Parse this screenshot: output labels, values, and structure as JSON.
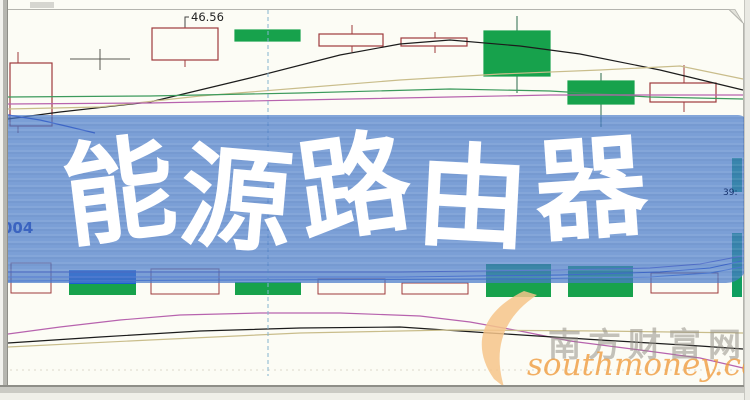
{
  "banner": {
    "title": "能源路由器",
    "chars": [
      {
        "ch": "能",
        "rot": -7,
        "dy": 2
      },
      {
        "ch": "源",
        "rot": 5,
        "dy": 10
      },
      {
        "ch": "路",
        "rot": -8,
        "dy": -3
      },
      {
        "ch": "由",
        "rot": 3,
        "dy": 8
      },
      {
        "ch": "器",
        "rot": -4,
        "dy": -1
      }
    ],
    "bg_rgba": "rgba(74,124,203,0.72)",
    "text_color": "#ffffff",
    "stock_code_fragment": "004",
    "small_price_label": "39:"
  },
  "price_label": {
    "value": "46.56"
  },
  "watermark": {
    "site_name": "南方财富网",
    "site_url": "southmoney.com",
    "name_color": "rgba(148,144,134,0.55)",
    "url_color": "rgba(238,152,58,0.78)",
    "swoosh_color": "rgba(246,196,138,0.85)"
  },
  "colors": {
    "chart_bg": "#fcfcf5",
    "frame": "#b4b4ae",
    "candle_up_outline": "#9e3a3c",
    "candle_down_fill": "#17a24c",
    "crosshair": "#85b4cf",
    "banner_blue": "#7b9dd9",
    "teal_under_banner": "#0f9f60"
  },
  "chart_data": {
    "type": "candlestick",
    "units": "pixels",
    "price_annotation": {
      "text": "46.56",
      "text_x": 191,
      "text_y": 21,
      "connector": [
        [
          185,
          27
        ],
        [
          185,
          17
        ],
        [
          189,
          17
        ]
      ]
    },
    "crosshair_x": 268,
    "candles": [
      {
        "x": 10,
        "w": 42,
        "top": 63,
        "bottom": 126,
        "wick_x": 18,
        "wick_top": 52,
        "wick_bottom": 133,
        "kind": "hollow"
      },
      {
        "x": 152,
        "w": 66,
        "top": 28,
        "bottom": 60,
        "wick_x": 185,
        "wick_top": 17,
        "wick_bottom": 67,
        "kind": "hollow"
      },
      {
        "x": 235,
        "w": 65,
        "top": 30,
        "bottom": 41,
        "wick_x": 268,
        "wick_top": 30,
        "wick_bottom": 41,
        "kind": "filled"
      },
      {
        "x": 319,
        "w": 64,
        "top": 34,
        "bottom": 46,
        "wick_x": 352,
        "wick_top": 25,
        "wick_bottom": 52,
        "kind": "hollow"
      },
      {
        "x": 401,
        "w": 66,
        "top": 38,
        "bottom": 46,
        "wick_x": 435,
        "wick_top": 32,
        "wick_bottom": 53,
        "kind": "hollow"
      },
      {
        "x": 484,
        "w": 66,
        "top": 31,
        "bottom": 76,
        "wick_x": 517,
        "wick_top": 16,
        "wick_bottom": 93,
        "kind": "filled"
      },
      {
        "x": 568,
        "w": 66,
        "top": 81,
        "bottom": 104,
        "wick_x": 601,
        "wick_top": 73,
        "wick_bottom": 127,
        "kind": "filled"
      },
      {
        "x": 650,
        "w": 66,
        "top": 83,
        "bottom": 102,
        "wick_x": 684,
        "wick_top": 65,
        "wick_bottom": 112,
        "kind": "hollow"
      }
    ],
    "doji": {
      "color": "#5a5a52",
      "cx": 100,
      "line_y": 59,
      "x1": 70,
      "x2": 130,
      "wick_top": 49,
      "wick_bottom": 70
    },
    "ma_lines": [
      {
        "name": "ma-black",
        "color": "#1c1c1c",
        "points": [
          [
            8,
            119
          ],
          [
            60,
            112
          ],
          [
            150,
            102
          ],
          [
            250,
            78
          ],
          [
            340,
            55
          ],
          [
            400,
            44
          ],
          [
            450,
            40
          ],
          [
            520,
            46
          ],
          [
            580,
            54
          ],
          [
            660,
            70
          ],
          [
            743,
            90
          ]
        ]
      },
      {
        "name": "ma-khaki",
        "color": "#c9bd8b",
        "points": [
          [
            8,
            109
          ],
          [
            100,
            107
          ],
          [
            200,
            96
          ],
          [
            300,
            88
          ],
          [
            400,
            80
          ],
          [
            500,
            74
          ],
          [
            600,
            70
          ],
          [
            680,
            66
          ],
          [
            743,
            79
          ]
        ]
      },
      {
        "name": "ma-green",
        "color": "#3c9a5c",
        "points": [
          [
            8,
            97
          ],
          [
            150,
            96
          ],
          [
            300,
            93
          ],
          [
            450,
            89
          ],
          [
            550,
            91
          ],
          [
            650,
            97
          ],
          [
            743,
            99
          ]
        ]
      },
      {
        "name": "ma-magenta",
        "color": "#b763ae",
        "points": [
          [
            8,
            104
          ],
          [
            150,
            103
          ],
          [
            300,
            100
          ],
          [
            450,
            97
          ],
          [
            550,
            95
          ],
          [
            650,
            95
          ],
          [
            743,
            95
          ]
        ]
      },
      {
        "name": "ma-blue",
        "color": "#2336c6",
        "points": [
          [
            8,
            115
          ],
          [
            40,
            120
          ],
          [
            70,
            127
          ],
          [
            95,
            133
          ]
        ]
      }
    ],
    "volume_bars": [
      {
        "x": 11,
        "w": 40,
        "segments": [
          {
            "y1": 263,
            "y2": 293,
            "fill": "none",
            "stroke": "#9e3a3c"
          }
        ]
      },
      {
        "x": 69,
        "w": 67,
        "segments": [
          {
            "y1": 270,
            "y2": 284,
            "fill": "#1a5fd0"
          },
          {
            "y1": 284,
            "y2": 295,
            "fill": "#17a24c"
          }
        ]
      },
      {
        "x": 151,
        "w": 68,
        "segments": [
          {
            "y1": 269,
            "y2": 294,
            "fill": "none",
            "stroke": "#9e3a3c"
          }
        ]
      },
      {
        "x": 235,
        "w": 66,
        "segments": [
          {
            "y1": 282,
            "y2": 295,
            "fill": "#17a24c"
          }
        ]
      },
      {
        "x": 318,
        "w": 67,
        "segments": [
          {
            "y1": 279,
            "y2": 294,
            "fill": "none",
            "stroke": "#9e3a3c"
          }
        ]
      },
      {
        "x": 402,
        "w": 66,
        "segments": [
          {
            "y1": 283,
            "y2": 294,
            "fill": "none",
            "stroke": "#9e3a3c"
          }
        ]
      },
      {
        "x": 486,
        "w": 65,
        "segments": [
          {
            "y1": 264,
            "y2": 297,
            "fill": "#17a24c"
          }
        ]
      },
      {
        "x": 568,
        "w": 65,
        "segments": [
          {
            "y1": 266,
            "y2": 297,
            "fill": "#17a24c"
          }
        ]
      },
      {
        "x": 651,
        "w": 67,
        "segments": [
          {
            "y1": 273,
            "y2": 293,
            "fill": "none",
            "stroke": "#9e3a3c"
          }
        ]
      },
      {
        "x": 732,
        "w": 10,
        "segments": [
          {
            "y1": 158,
            "y2": 192,
            "fill": "#0f9f60"
          },
          {
            "y1": 233,
            "y2": 297,
            "fill": "#0f9f60"
          }
        ]
      }
    ],
    "volume_lines": [
      {
        "color": "#6a55c8",
        "points": [
          [
            8,
            272
          ],
          [
            200,
            272
          ],
          [
            400,
            272
          ],
          [
            560,
            270
          ],
          [
            650,
            268
          ],
          [
            700,
            264
          ],
          [
            742,
            256
          ]
        ]
      },
      {
        "color": "#2a3ec8",
        "points": [
          [
            8,
            277
          ],
          [
            200,
            277
          ],
          [
            400,
            277
          ],
          [
            560,
            275
          ],
          [
            660,
            272
          ],
          [
            710,
            268
          ],
          [
            742,
            261
          ]
        ]
      },
      {
        "color": "#4a6ad8",
        "points": [
          [
            8,
            281
          ],
          [
            250,
            280
          ],
          [
            500,
            279
          ],
          [
            650,
            277
          ],
          [
            710,
            273
          ],
          [
            742,
            267
          ]
        ]
      }
    ],
    "indicator_lines": [
      {
        "name": "ind-magenta",
        "color": "#b763ae",
        "points": [
          [
            8,
            334
          ],
          [
            60,
            327
          ],
          [
            120,
            320
          ],
          [
            180,
            315
          ],
          [
            260,
            313
          ],
          [
            340,
            313
          ],
          [
            420,
            316
          ],
          [
            470,
            322
          ],
          [
            520,
            331
          ],
          [
            570,
            341
          ],
          [
            640,
            350
          ],
          [
            700,
            358
          ],
          [
            743,
            368
          ]
        ]
      },
      {
        "name": "ind-black",
        "color": "#1c1c1c",
        "points": [
          [
            8,
            343
          ],
          [
            100,
            337
          ],
          [
            200,
            331
          ],
          [
            300,
            328
          ],
          [
            400,
            327
          ],
          [
            490,
            333
          ],
          [
            600,
            340
          ],
          [
            700,
            346
          ],
          [
            743,
            349
          ]
        ]
      },
      {
        "name": "ind-khaki",
        "color": "#c9bd8b",
        "points": [
          [
            8,
            347
          ],
          [
            150,
            340
          ],
          [
            300,
            333
          ],
          [
            450,
            330
          ],
          [
            600,
            331
          ],
          [
            743,
            333
          ]
        ]
      }
    ],
    "gridline_y": 370,
    "xlim": [
      0,
      750
    ],
    "ylim_px": [
      0,
      400
    ],
    "legend": "none",
    "axes_labels": "none"
  }
}
